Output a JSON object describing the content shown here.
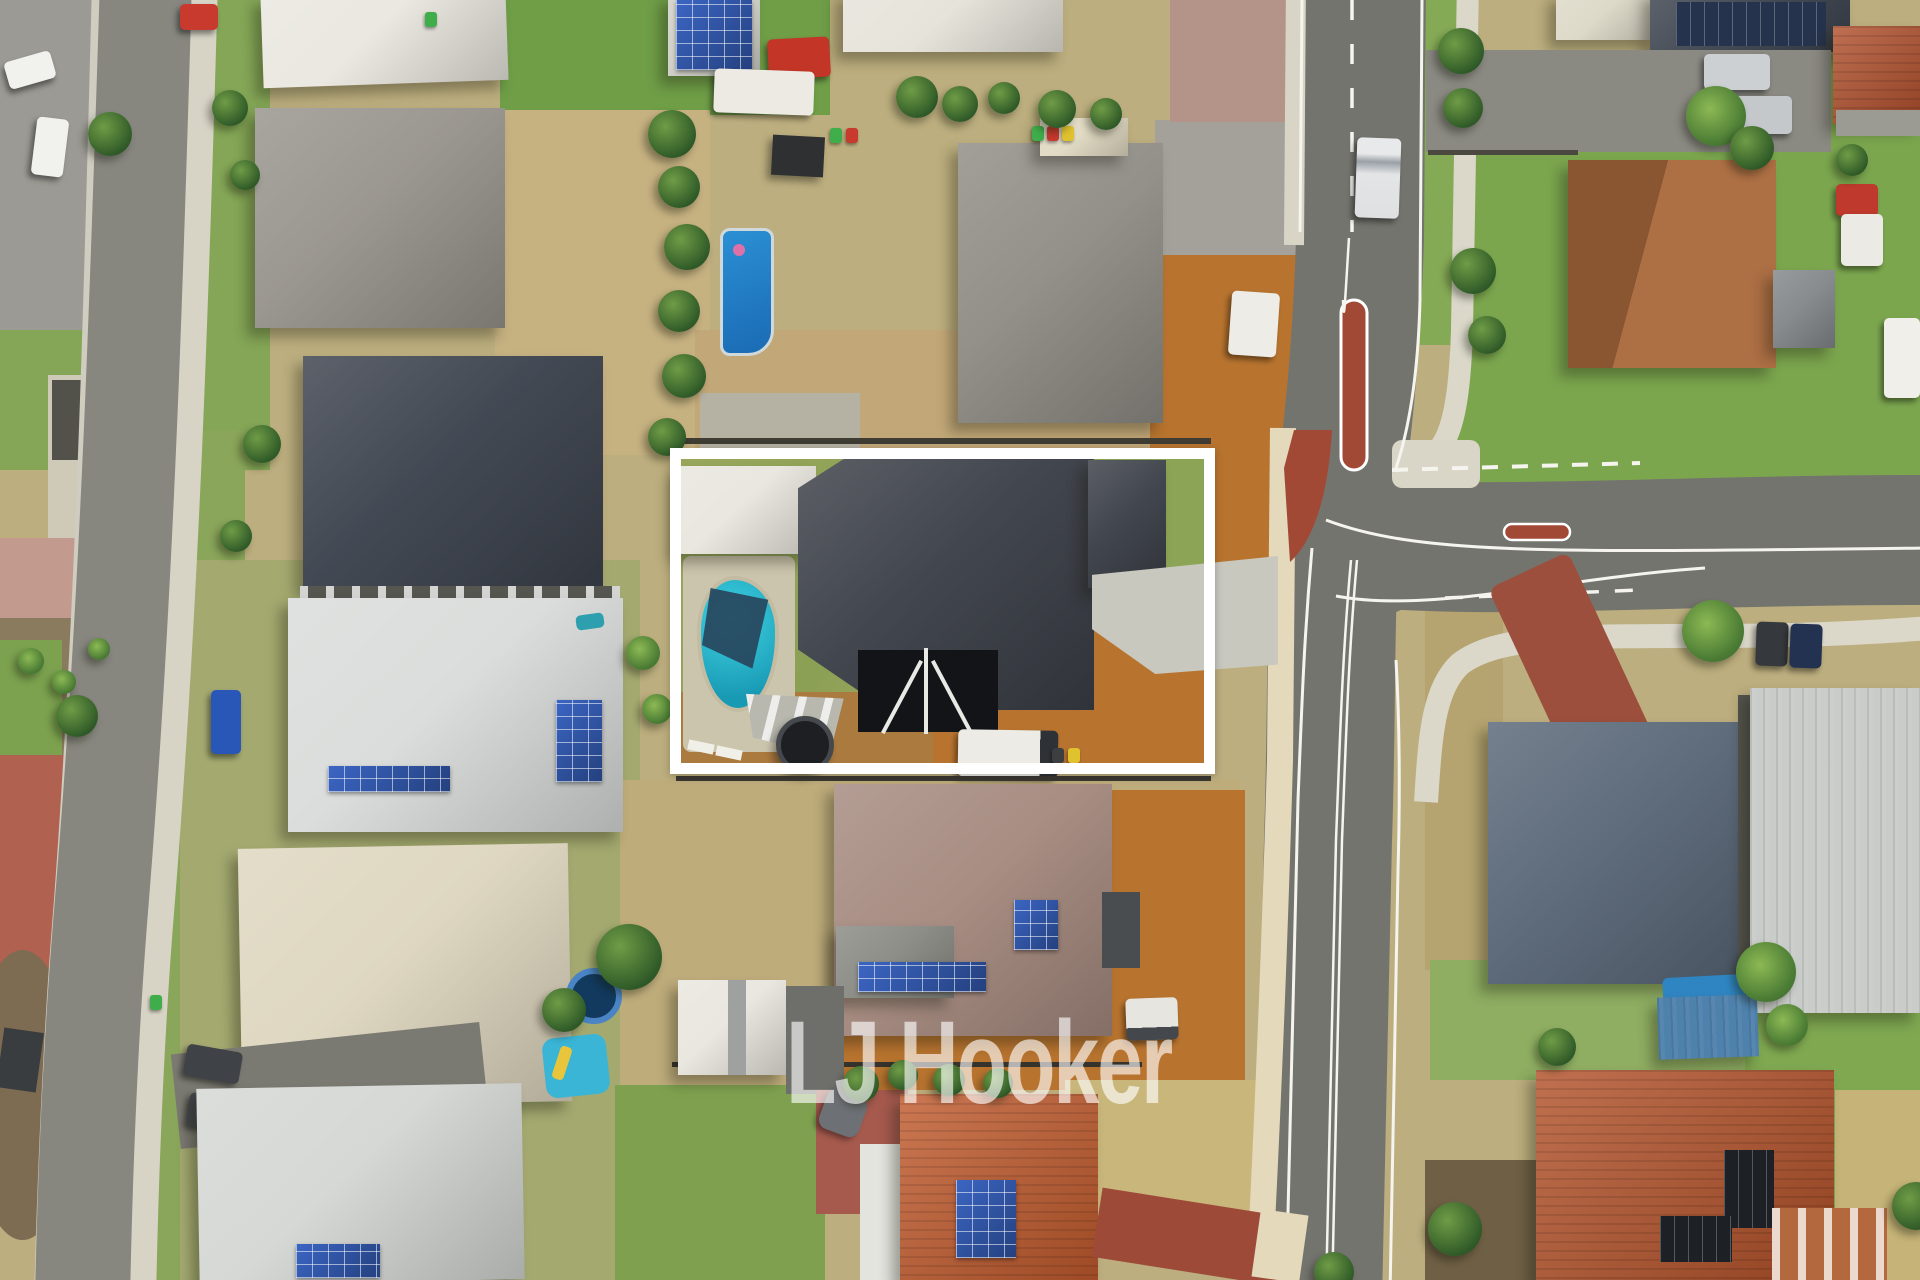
{
  "image": {
    "type": "aerial-drone-photograph",
    "subject": "suburban residential neighbourhood, top-down view, with one property lot highlighted by a white rectangular outline"
  },
  "watermark": {
    "text": "LJ Hooker",
    "color": "#ffffff"
  },
  "boundary": {
    "shape": "rectangle",
    "color": "#ffffff",
    "purpose": "highlights the listed property: charcoal-roof house with pool, trampoline, caravan and bare-earth yard on a corner lot"
  },
  "palette": {
    "lawn_green": "#7aa24d",
    "dry_grass": "#c2b17e",
    "bare_dirt_orange": "#b8742f",
    "asphalt_road": "#74746e",
    "concrete_path": "#d8d5c7",
    "cream_path": "#e4d9bb",
    "brick_red_median": "#a24936",
    "featured_roof_charcoal": "#3c4048",
    "pool_teal": "#2fc6d9",
    "pool_blue": "#1f7ec9",
    "terracotta_roof": "#c05a2d",
    "rust_roof": "#b25129",
    "cream_roof": "#ded6bf",
    "white_roof": "#e8eae7",
    "grey_roof": "#98948d",
    "dark_navy_roof": "#3d434e",
    "blue_grey_roof": "#5a6878",
    "brown_roof": "#a58a7f",
    "silver_roof": "#c9ccc9",
    "solar_panel_blue": "#2b4fa0",
    "road_marking_white": "#f5f4ef"
  }
}
